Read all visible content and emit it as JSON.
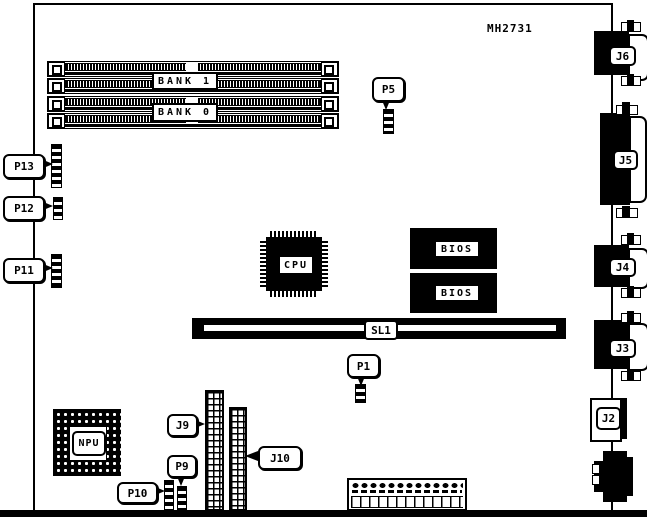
{
  "board": {
    "part_number": "MH2731"
  },
  "memory": {
    "bank1": "BANK 1",
    "bank0": "BANK 0"
  },
  "chips": {
    "cpu": "CPU",
    "npu": "NPU",
    "bios_top": "BIOS",
    "bios_bottom": "BIOS"
  },
  "slots": {
    "sl1": "SL1"
  },
  "callouts": {
    "p1": "P1",
    "p5": "P5",
    "p9": "P9",
    "p10": "P10",
    "p11": "P11",
    "p12": "P12",
    "p13": "P13",
    "j9": "J9",
    "j10": "J10"
  },
  "edge_connectors": {
    "j2": "J2",
    "j3": "J3",
    "j4": "J4",
    "j5": "J5",
    "j6": "J6"
  },
  "colors": {
    "ink": "#000000",
    "background": "#ffffff"
  }
}
